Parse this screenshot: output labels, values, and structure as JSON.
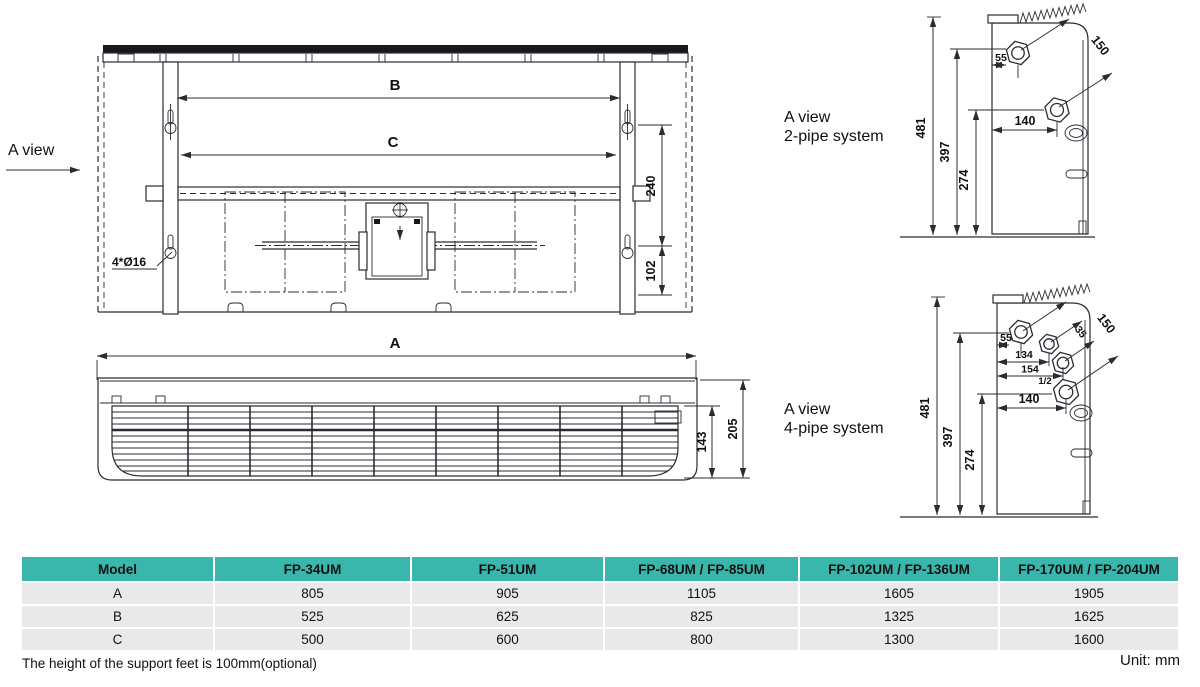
{
  "colors": {
    "line": "#2b2b33",
    "dark_fill": "#17171d",
    "table_header_bg": "#3ab7ac",
    "table_row_bg": "#e9e9e9"
  },
  "rear_view": {
    "a_view_label": "A view",
    "dim_b": "B",
    "dim_c": "C",
    "dim_240": "240",
    "dim_102": "102",
    "holes_label": "4*Ø16"
  },
  "front_view": {
    "dim_a": "A",
    "dim_143": "143",
    "dim_205": "205"
  },
  "pipe2": {
    "title_line1": "A view",
    "title_line2": "2-pipe system",
    "d481": "481",
    "d397": "397",
    "d274": "274",
    "d140": "140",
    "d55": "55",
    "d150": "150"
  },
  "pipe4": {
    "title_line1": "A view",
    "title_line2": "4-pipe system",
    "d481": "481",
    "d397": "397",
    "d274": "274",
    "d140": "140",
    "d55": "55",
    "d150": "150",
    "d134": "134",
    "d154": "154",
    "d35": "35",
    "dhalf": "1/2"
  },
  "table": {
    "headers": [
      "Model",
      "FP-34UM",
      "FP-51UM",
      "FP-68UM / FP-85UM",
      "FP-102UM / FP-136UM",
      "FP-170UM / FP-204UM"
    ],
    "rows": [
      {
        "label": "A",
        "values": [
          "805",
          "905",
          "1105",
          "1605",
          "1905"
        ]
      },
      {
        "label": "B",
        "values": [
          "525",
          "625",
          "825",
          "1325",
          "1625"
        ]
      },
      {
        "label": "C",
        "values": [
          "500",
          "600",
          "800",
          "1300",
          "1600"
        ]
      }
    ]
  },
  "footer": {
    "note": "The height of the support feet is 100mm(optional)",
    "unit": "Unit: mm"
  }
}
